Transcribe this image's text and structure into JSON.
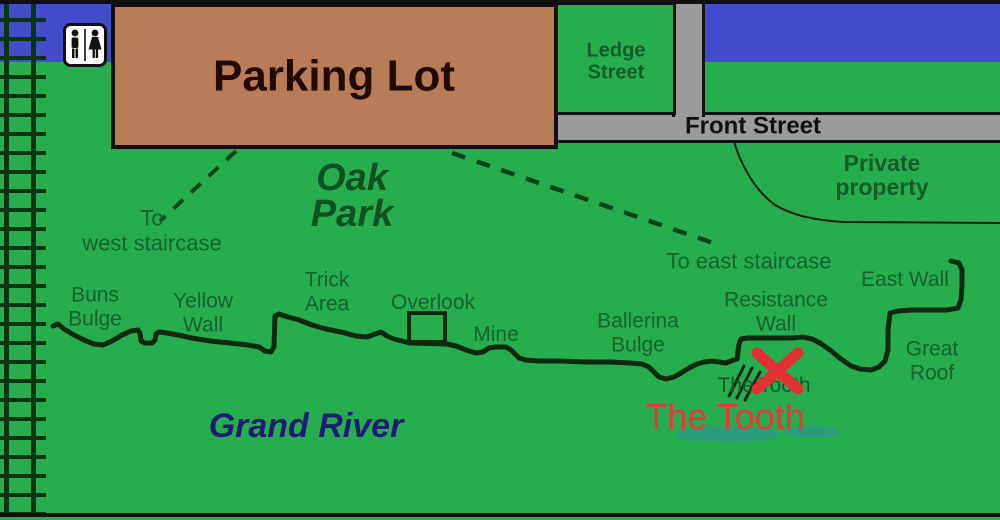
{
  "labels": {
    "parking_lot": "Parking Lot",
    "ledge_street": "Ledge\nStreet",
    "front_street": "Front Street",
    "private_property": "Private\nproperty",
    "oak_park": "Oak\nPark",
    "grand_river": "Grand River",
    "to_west_staircase": "To\nwest staircase",
    "to_east_staircase": "To east staircase",
    "tooth_small": "The Tooth",
    "tooth_large": "The Tooth"
  },
  "crags": [
    {
      "id": "buns-bulge",
      "label": "Buns\nBulge"
    },
    {
      "id": "yellow-wall",
      "label": "Yellow\nWall"
    },
    {
      "id": "trick-area",
      "label": "Trick\nArea"
    },
    {
      "id": "overlook",
      "label": "Overlook"
    },
    {
      "id": "mine",
      "label": "Mine"
    },
    {
      "id": "ballerina-bulge",
      "label": "Ballerina\nBulge"
    },
    {
      "id": "resistance-wall",
      "label": "Resistance\nWall"
    },
    {
      "id": "east-wall",
      "label": "East Wall"
    },
    {
      "id": "great-roof",
      "label": "Great\nRoof"
    }
  ],
  "icons": [
    {
      "name": "restroom-icon",
      "glyph": "man-and-woman-silhouettes"
    },
    {
      "name": "tooth-x-marker",
      "glyph": "red-x"
    }
  ],
  "colors": {
    "park_green": "#27ad4f",
    "river_blue": "#444cc9",
    "road_gray": "#9b9b9b",
    "parking_tan": "#ba7c57",
    "label_green": "#156329",
    "dark_line_green": "#0b2a10",
    "marker_red": "#e23131",
    "river_text_navy": "#1d1d72",
    "shallow_teal": "#2d9a84"
  }
}
